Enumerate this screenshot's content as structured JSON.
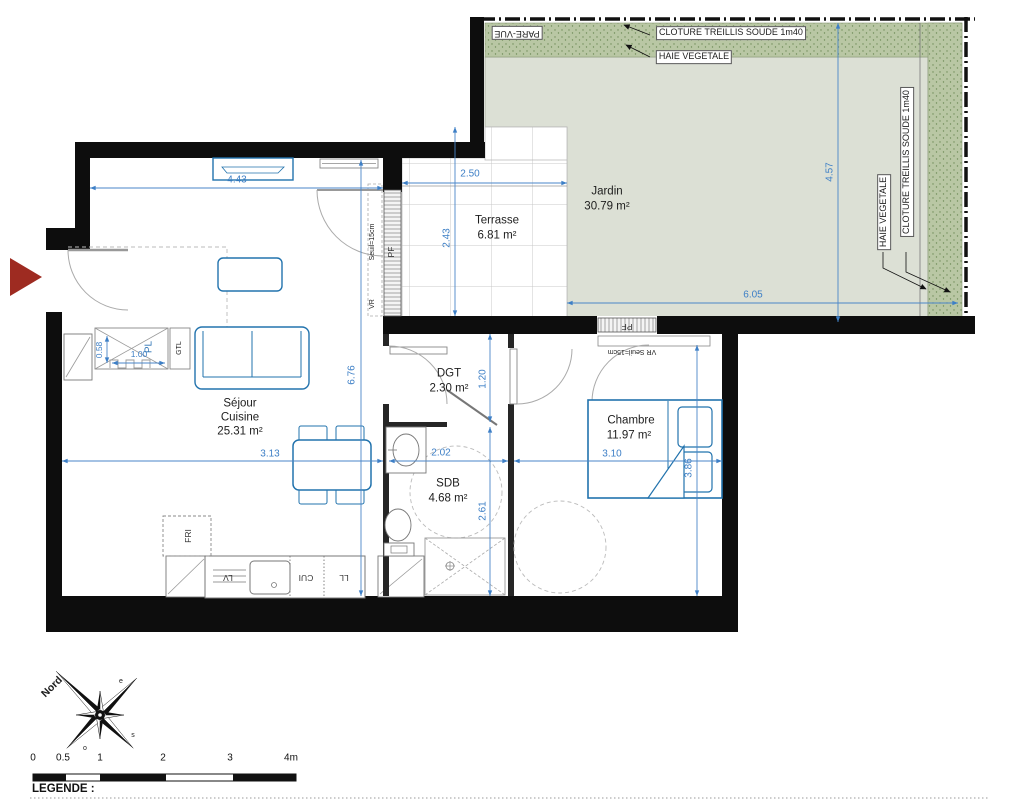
{
  "site": {
    "pare_vue": "PARE-VUE",
    "cloture_top": "CLOTURE TREILLIS SOUDE 1m40",
    "haie_top": "HAIE VEGETALE",
    "haie_right": "HAIE VEGETALE",
    "cloture_right": "CLOTURE TREILLIS SOUDE 1m40"
  },
  "rooms": {
    "jardin": {
      "name": "Jardin",
      "area": "30.79 m²"
    },
    "terrasse": {
      "name": "Terrasse",
      "area": "6.81 m²"
    },
    "sejour": {
      "line1": "Séjour",
      "line2": "Cuisine",
      "area": "25.31 m²"
    },
    "dgt": {
      "name": "DGT",
      "area": "2.30 m²"
    },
    "sdb": {
      "name": "SDB",
      "area": "4.68 m²"
    },
    "chambre": {
      "name": "Chambre",
      "area": "11.97 m²"
    }
  },
  "dimensions": {
    "sejour_width_top": "4.43",
    "terrasse_width": "2.50",
    "terrasse_depth": "2.43",
    "jardin_depth": "4.57",
    "jardin_width": "6.05",
    "sejour_height": "6.76",
    "sejour_width_mid": "3.13",
    "dgt_depth": "1.20",
    "sdb_width": "2.02",
    "sdb_depth": "2.61",
    "chambre_width": "3.10",
    "chambre_depth": "3.86",
    "entry_niche_depth": "0.58",
    "entry_niche_width": "1.00"
  },
  "fixtures": {
    "pl": "PL",
    "gtl": "GTL",
    "fri": "FRI",
    "lv": "LV",
    "cui": "CUI",
    "ll": "LL",
    "pf": "PF",
    "vr": "VR",
    "seuil": "Seuil=15cm",
    "vr_seuil": "VR Seuil=15cm"
  },
  "compass": {
    "north": "Nord",
    "east": "e",
    "south": "s",
    "west": "o"
  },
  "scale_bar": {
    "ticks": [
      "0",
      "0.5",
      "1",
      "2",
      "3",
      "4m"
    ]
  },
  "legend_title": "LEGENDE :",
  "colors": {
    "wall": "#0d0d0d",
    "dimension_blue": "#3d7fc6",
    "furniture_blue": "#2273ad",
    "garden_fill": "#dce0d5",
    "hedge_fill": "#b9c7a4",
    "entrance_arrow_red": "#9e2b21"
  }
}
